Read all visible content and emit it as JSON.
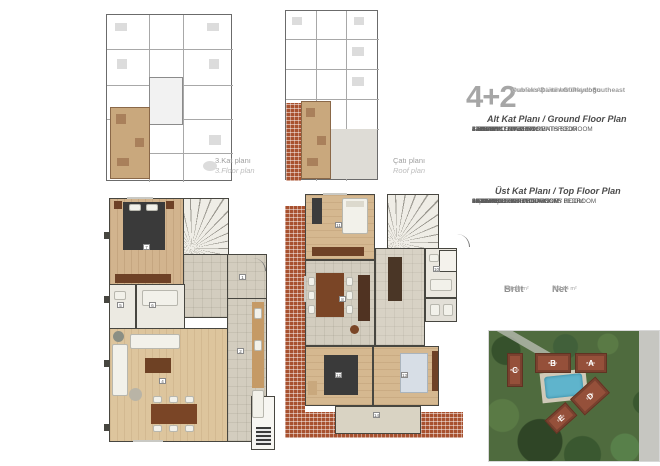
{
  "header": {
    "type_number": "4+2",
    "line1": "Dubleks Daire / Güneydoğu",
    "line2": "Dublex Apartment Plan / Southeast",
    "line3": "Çatı Dublexli / Roof Dublex"
  },
  "mini_plans": [
    {
      "label_tr": "3.Kat planı",
      "label_en": "3.Floor plan"
    },
    {
      "label_tr": "Çatı planı",
      "label_en": "Roof plan"
    }
  ],
  "ground_floor": {
    "heading": "Alt Kat Planı / Ground Floor Plan",
    "rooms": [
      {
        "name": "1.ANTRE / ENTREE",
        "area": "11.93 m²"
      },
      {
        "name": "2.MUTFAK / KITCHEN",
        "area": "11.28 m²"
      },
      {
        "name": "3.BALKON / BALCONY",
        "area": "2.72 m²"
      },
      {
        "name": "4.SALON / LIVING ROOM",
        "area": "27.98 m²"
      },
      {
        "name": "5.WC / WC",
        "area": "2.50 m²"
      },
      {
        "name": "6.E.BANYO / PARENTS BATHROOM",
        "area": "4.00 m²"
      },
      {
        "name": "7.E.YATAK ODASI / PARENTS BEDROOM",
        "area": "14.59 m²"
      }
    ],
    "markers": [
      "1",
      "2",
      "4",
      "5",
      "6",
      "7"
    ]
  },
  "top_floor": {
    "heading": "Üst Kat Planı / Top Floor Plan",
    "rooms": [
      {
        "name": "8.SOFA / SOFA",
        "area": "17.29 m²"
      },
      {
        "name": "9.ÇAMAŞIR ODASI / LAUNDRY ROOM",
        "area": "2.36 m²"
      },
      {
        "name": "10.BANYO / BATHROOM",
        "area": "4.36 m²"
      },
      {
        "name": "11.YATAK ODASI / BEDROOM",
        "area": "15.38 m²"
      },
      {
        "name": "12.E.YATAK ODASI / PARENTS BEDROOM",
        "area": "15.09 m²"
      },
      {
        "name": "13.YATAK ODASI / BEDROOM",
        "area": "11.74 m²"
      },
      {
        "name": "14.TERAS / TERRACE",
        "area": "9.80 m²"
      },
      {
        "name": "15.TERAS / TERRACE",
        "area": "5.27 m²"
      },
      {
        "name": "16.DEPO / STORE",
        "area": "5.49 m²"
      }
    ],
    "markers": [
      "8",
      "10",
      "11",
      "12",
      "13",
      "14"
    ]
  },
  "totals": {
    "brut_label": "Brüt",
    "brut_sub": "Gross",
    "brut_value": "236,36 m²",
    "net_label": "Net",
    "net_sub": "Net",
    "net_value": "162,94 m²"
  },
  "site_plan": {
    "blocks": [
      {
        "letter": "A",
        "sub": "BLOK"
      },
      {
        "letter": "B",
        "sub": "BLOK"
      },
      {
        "letter": "C",
        "sub": "BLOK"
      },
      {
        "letter": "D",
        "sub": "BLOK"
      },
      {
        "letter": "E",
        "sub": "BLOK"
      }
    ]
  },
  "colors": {
    "accent_brick": "#a8512f",
    "wood": "#d2b48e",
    "wall": "#474640",
    "text_gray": "#9d9d9d",
    "building": "#95503a",
    "pool": "#5fb4cc"
  }
}
